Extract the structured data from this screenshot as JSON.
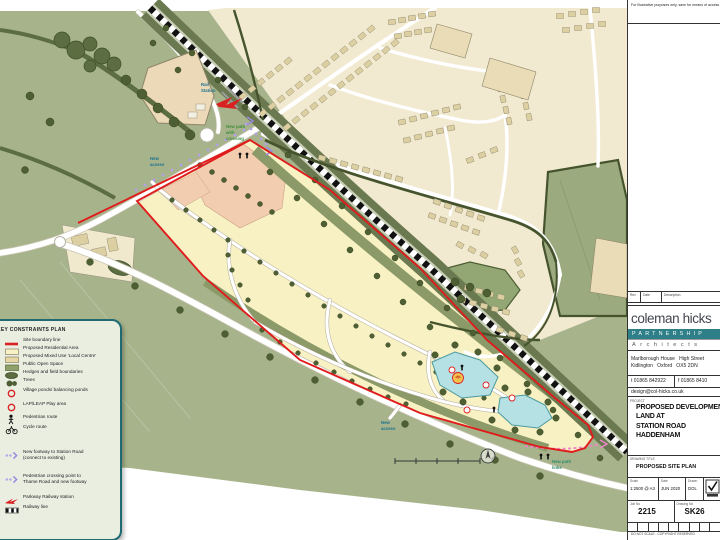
{
  "note": {
    "text": "For illustrative purposes only, save for means of access"
  },
  "legend": {
    "title": "KEY CONSTRAINTS PLAN",
    "items": [
      {
        "icon": "site-boundary-line-icon",
        "label": "Site boundary line"
      },
      {
        "icon": "residential-area-swatch",
        "label": "Proposed Residential Area"
      },
      {
        "icon": "mixed-use-swatch",
        "label": "Proposed Mixed Use 'Local Centre'"
      },
      {
        "icon": "open-space-swatch",
        "label": "Public Open Space"
      },
      {
        "icon": "hedges-swatch",
        "label": "Hedges and field boundaries"
      },
      {
        "icon": "trees-icon",
        "label": "Trees"
      },
      {
        "icon": "pond-icon",
        "label": "Village ponds/ balancing ponds"
      },
      {
        "icon": "play-area-icon",
        "label": "LAP/LEAP Play area"
      },
      {
        "icon": "pedestrian-route-icon",
        "label": "Pedestrian route"
      },
      {
        "icon": "cycle-route-icon",
        "label": "Cycle route"
      },
      {
        "icon": "new-footway-icon",
        "label": "New footway to Station Road",
        "label2": "(connect to existing)"
      },
      {
        "icon": "crossing-point-icon",
        "label": "Pedestrian crossing point to",
        "label2": "Thame Road and new footway"
      },
      {
        "icon": "parkway-station-icon",
        "label": "Parkway Railway station"
      },
      {
        "icon": "railway-line-icon",
        "label": "Railway line"
      }
    ]
  },
  "map": {
    "labels": {
      "rail_station": [
        "Rail",
        "Station"
      ],
      "new_path_crossing": [
        "New path",
        "with",
        "crossing"
      ],
      "new_access_north": [
        "New",
        "access"
      ],
      "new_access_south": [
        "New",
        "access"
      ],
      "new_path_links": [
        "New path",
        "links"
      ]
    }
  },
  "title_block": {
    "rev_headers": [
      "Rev",
      "Date",
      "Description"
    ],
    "firm_name": "coleman hicks",
    "partnership": "PARTNERSHIP",
    "architects": "Architects",
    "address1": "Marlborough House   High Street",
    "address2": "Kidlington   Oxford   OX5 2DN",
    "tel": "t 01865 842922",
    "fax": "f 01865 8410",
    "email": "design@col-hicks.co.uk",
    "project_label": "PROJECT",
    "project_lines": [
      "PROPOSED DEVELOPMENT",
      "LAND AT",
      "STATION ROAD",
      "HADDENHAM"
    ],
    "drawing_title_label": "DRAWING TITLE",
    "drawing_title": "PROPOSED SITE PLAN",
    "scale_label": "Scale",
    "scale_value": "1:2500 @ A3",
    "date_label": "Date",
    "date_value": "JUN 2020",
    "drawn_label": "Drawn",
    "drawn_value": "DOL",
    "job_label": "Job No",
    "job_value": "2215",
    "drawing_no_label": "Drawing No",
    "drawing_no_value": "SK26",
    "footer": "DO NOT SCALE - COPYRIGHT RESERVED"
  },
  "colors": {
    "site_boundary": "#e01b1b",
    "residential": "#f8f1c4",
    "mixed_use": "#f3cdb0",
    "open_space": "#8b9a68",
    "field_green": "#a7b48b",
    "pond": "#b5e0e4",
    "brand_teal": "#2e7f88",
    "legend_border": "#1f6a73"
  }
}
